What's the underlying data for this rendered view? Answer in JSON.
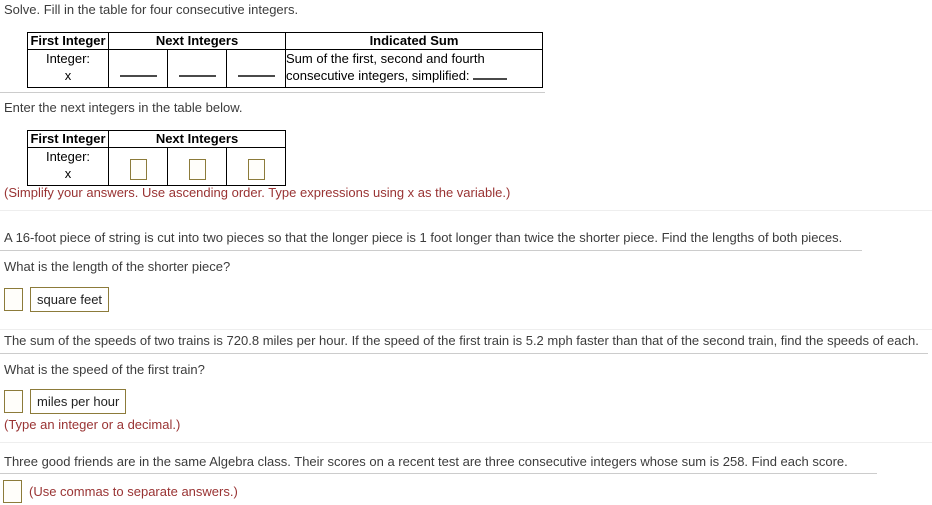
{
  "colors": {
    "body_text": "#3c3c3c",
    "table_text": "#000000",
    "note_maroon": "#993333",
    "input_border_tan": "#8c7b3a",
    "table_border": "#000000",
    "divider_strong": "#cccccc",
    "divider_faint": "#eeeeee"
  },
  "problem1": {
    "prompt": "Solve. Fill in the table for four consecutive integers.",
    "table": {
      "headers": [
        "First Integer",
        "Next Integers",
        "Indicated Sum"
      ],
      "row_label": "Integer:",
      "row_variable": "x",
      "sum_line1": "Sum of the first, second and fourth",
      "sum_line2": "consecutive integers, simplified:"
    }
  },
  "problem2": {
    "prompt": "Enter the next integers in the table below.",
    "table": {
      "headers": [
        "First Integer",
        "Next Integers"
      ],
      "row_label": "Integer:",
      "row_variable": "x",
      "input_values": [
        "",
        "",
        ""
      ]
    },
    "note": "(Simplify your answers. Use ascending order. Type expressions using x as the variable.)"
  },
  "problem3": {
    "statement": "A 16-foot piece of string is cut into two pieces so that the longer piece is 1 foot longer than twice the shorter piece. Find the lengths of both pieces.",
    "question": "What is the length of the shorter piece?",
    "answer_value": "",
    "unit_label": "square feet"
  },
  "problem4": {
    "statement": "The sum of the speeds of two trains is 720.8 miles per hour. If the speed of the first train is 5.2 mph faster than that of the second train, find the speeds of each.",
    "question": "What is the speed of the first train?",
    "answer_value": "",
    "unit_label": "miles per hour",
    "note": "(Type an integer or a decimal.)"
  },
  "problem5": {
    "statement": "Three good friends are in the same Algebra class. Their scores on a recent test are three consecutive integers whose sum is 258. Find each score.",
    "answer_value": "",
    "note": "(Use commas to separate answers.)"
  }
}
